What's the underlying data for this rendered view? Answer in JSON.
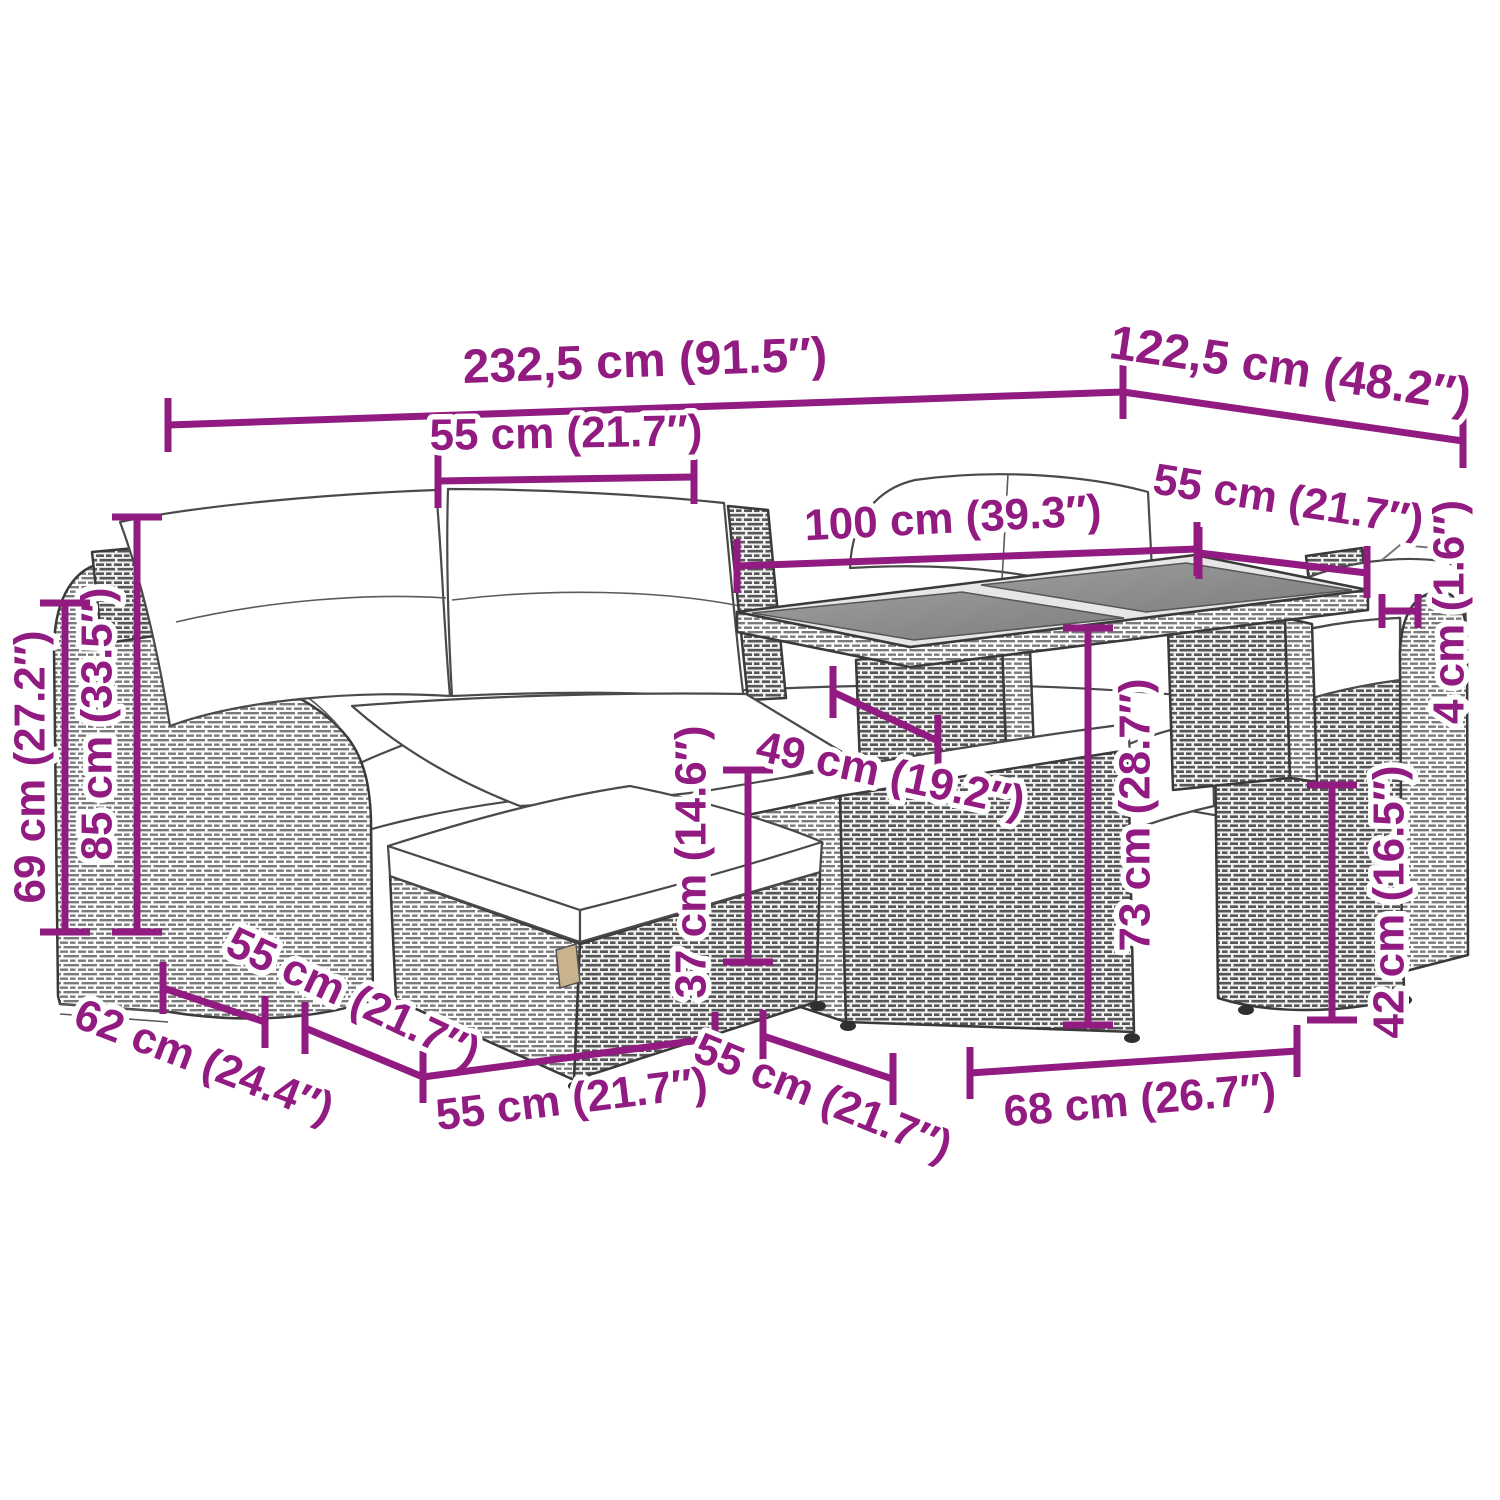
{
  "diagram": {
    "title": "garden furniture set dimension drawing",
    "accent_color": "#911B81",
    "unit_system": "cm (inches)",
    "dims": {
      "total_width": "232,5 cm (91.5″)",
      "total_depth": "122,5 cm (48.2″)",
      "backrest_width": "55 cm (21.7″)",
      "table_length": "100 cm (39.3″)",
      "table_width": "55 cm (21.7″)",
      "tabletop_thickness": "4 cm (1.6″)",
      "backrest_height": "85 cm (33.5″)",
      "arm_height": "69 cm (27.2″)",
      "arm_depth": "62 cm (24.4″)",
      "seat_module_depth": "55 cm (21.7″)",
      "seat_module_width": "55 cm (21.7″)",
      "ottoman_depth": "55 cm (21.7″)",
      "table_base_width": "68 cm (26.7″)",
      "ottoman_height": "37 cm (14.6″)",
      "seat_depth": "49 cm (19.2″)",
      "table_height": "73 cm (28.7″)",
      "seat_height": "42 cm (16.5″)"
    }
  }
}
